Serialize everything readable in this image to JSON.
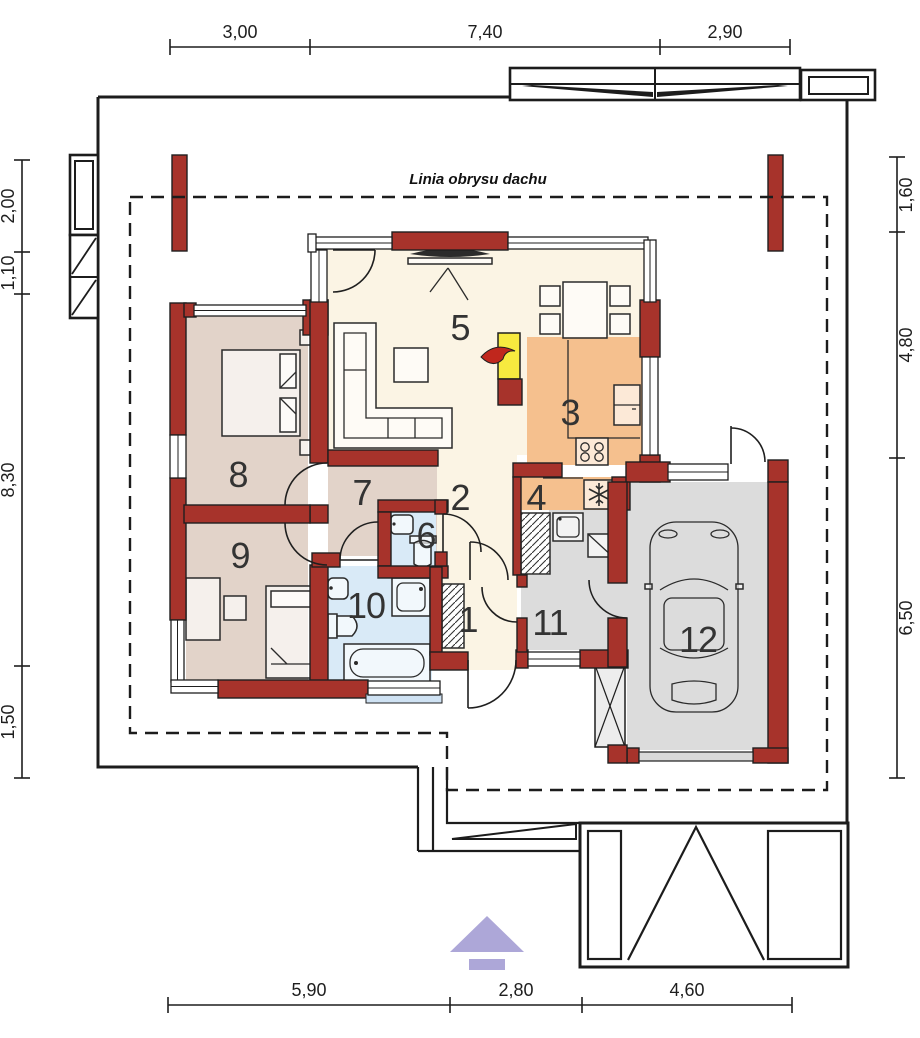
{
  "site": {
    "roof_label": "Linia obrysu dachu"
  },
  "dimensions": {
    "top": [
      "3,00",
      "7,40",
      "2,90"
    ],
    "bottom": [
      "5,90",
      "2,80",
      "4,60"
    ],
    "left": [
      "2,00",
      "1,10",
      "8,30",
      "1,50"
    ],
    "right": [
      "1,60",
      "4,80",
      "6,50"
    ]
  },
  "rooms": [
    {
      "number": "1"
    },
    {
      "number": "2"
    },
    {
      "number": "3"
    },
    {
      "number": "4"
    },
    {
      "number": "5"
    },
    {
      "number": "6"
    },
    {
      "number": "7"
    },
    {
      "number": "8"
    },
    {
      "number": "9"
    },
    {
      "number": "10"
    },
    {
      "number": "11"
    },
    {
      "number": "12"
    }
  ],
  "colors": {
    "wall": "#a7332b",
    "floor_cream": "#fbf4e4",
    "floor_tan": "#e2d3c9",
    "floor_blue": "#d9eaf7",
    "floor_orange": "#f5c08e",
    "floor_gray": "#dcdcdc",
    "fireplace_yellow": "#f7ea3f",
    "flame_red": "#c0271d",
    "arrow_purple": "#ada7d8",
    "window_blue": "#cfe2f3"
  }
}
